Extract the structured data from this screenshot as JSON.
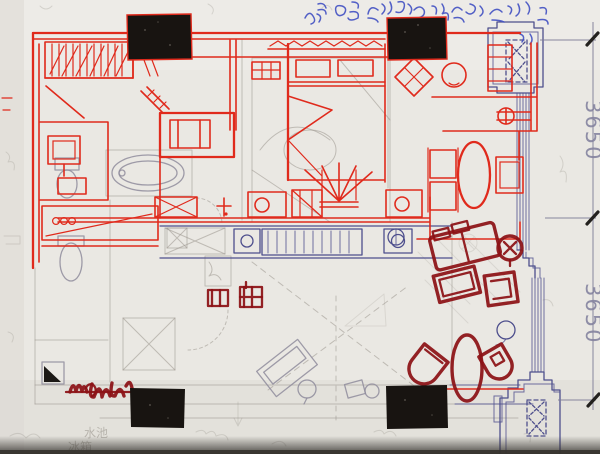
{
  "colors": {
    "paper": "#eae8e3",
    "paper-light": "#f2f0eb",
    "paper-dark": "#dcd9d3",
    "edge-shadow": "#35322e",
    "pencil": "#9b968e",
    "pencil-blue": "#8f8c9c",
    "blue-ink": "#4e4f8d",
    "blue-hand": "#4050c2",
    "red-ink": "#e02a1c",
    "dark-red": "#8c1115",
    "column-black": "#181411",
    "dim-text": "#84839f",
    "dim-line": "#7c7b95",
    "tick-black": "#23211e"
  },
  "dimensions": {
    "upper": "3650",
    "lower": "3650"
  },
  "annotations": {
    "sink": "水池",
    "fridge": "冰箱"
  }
}
